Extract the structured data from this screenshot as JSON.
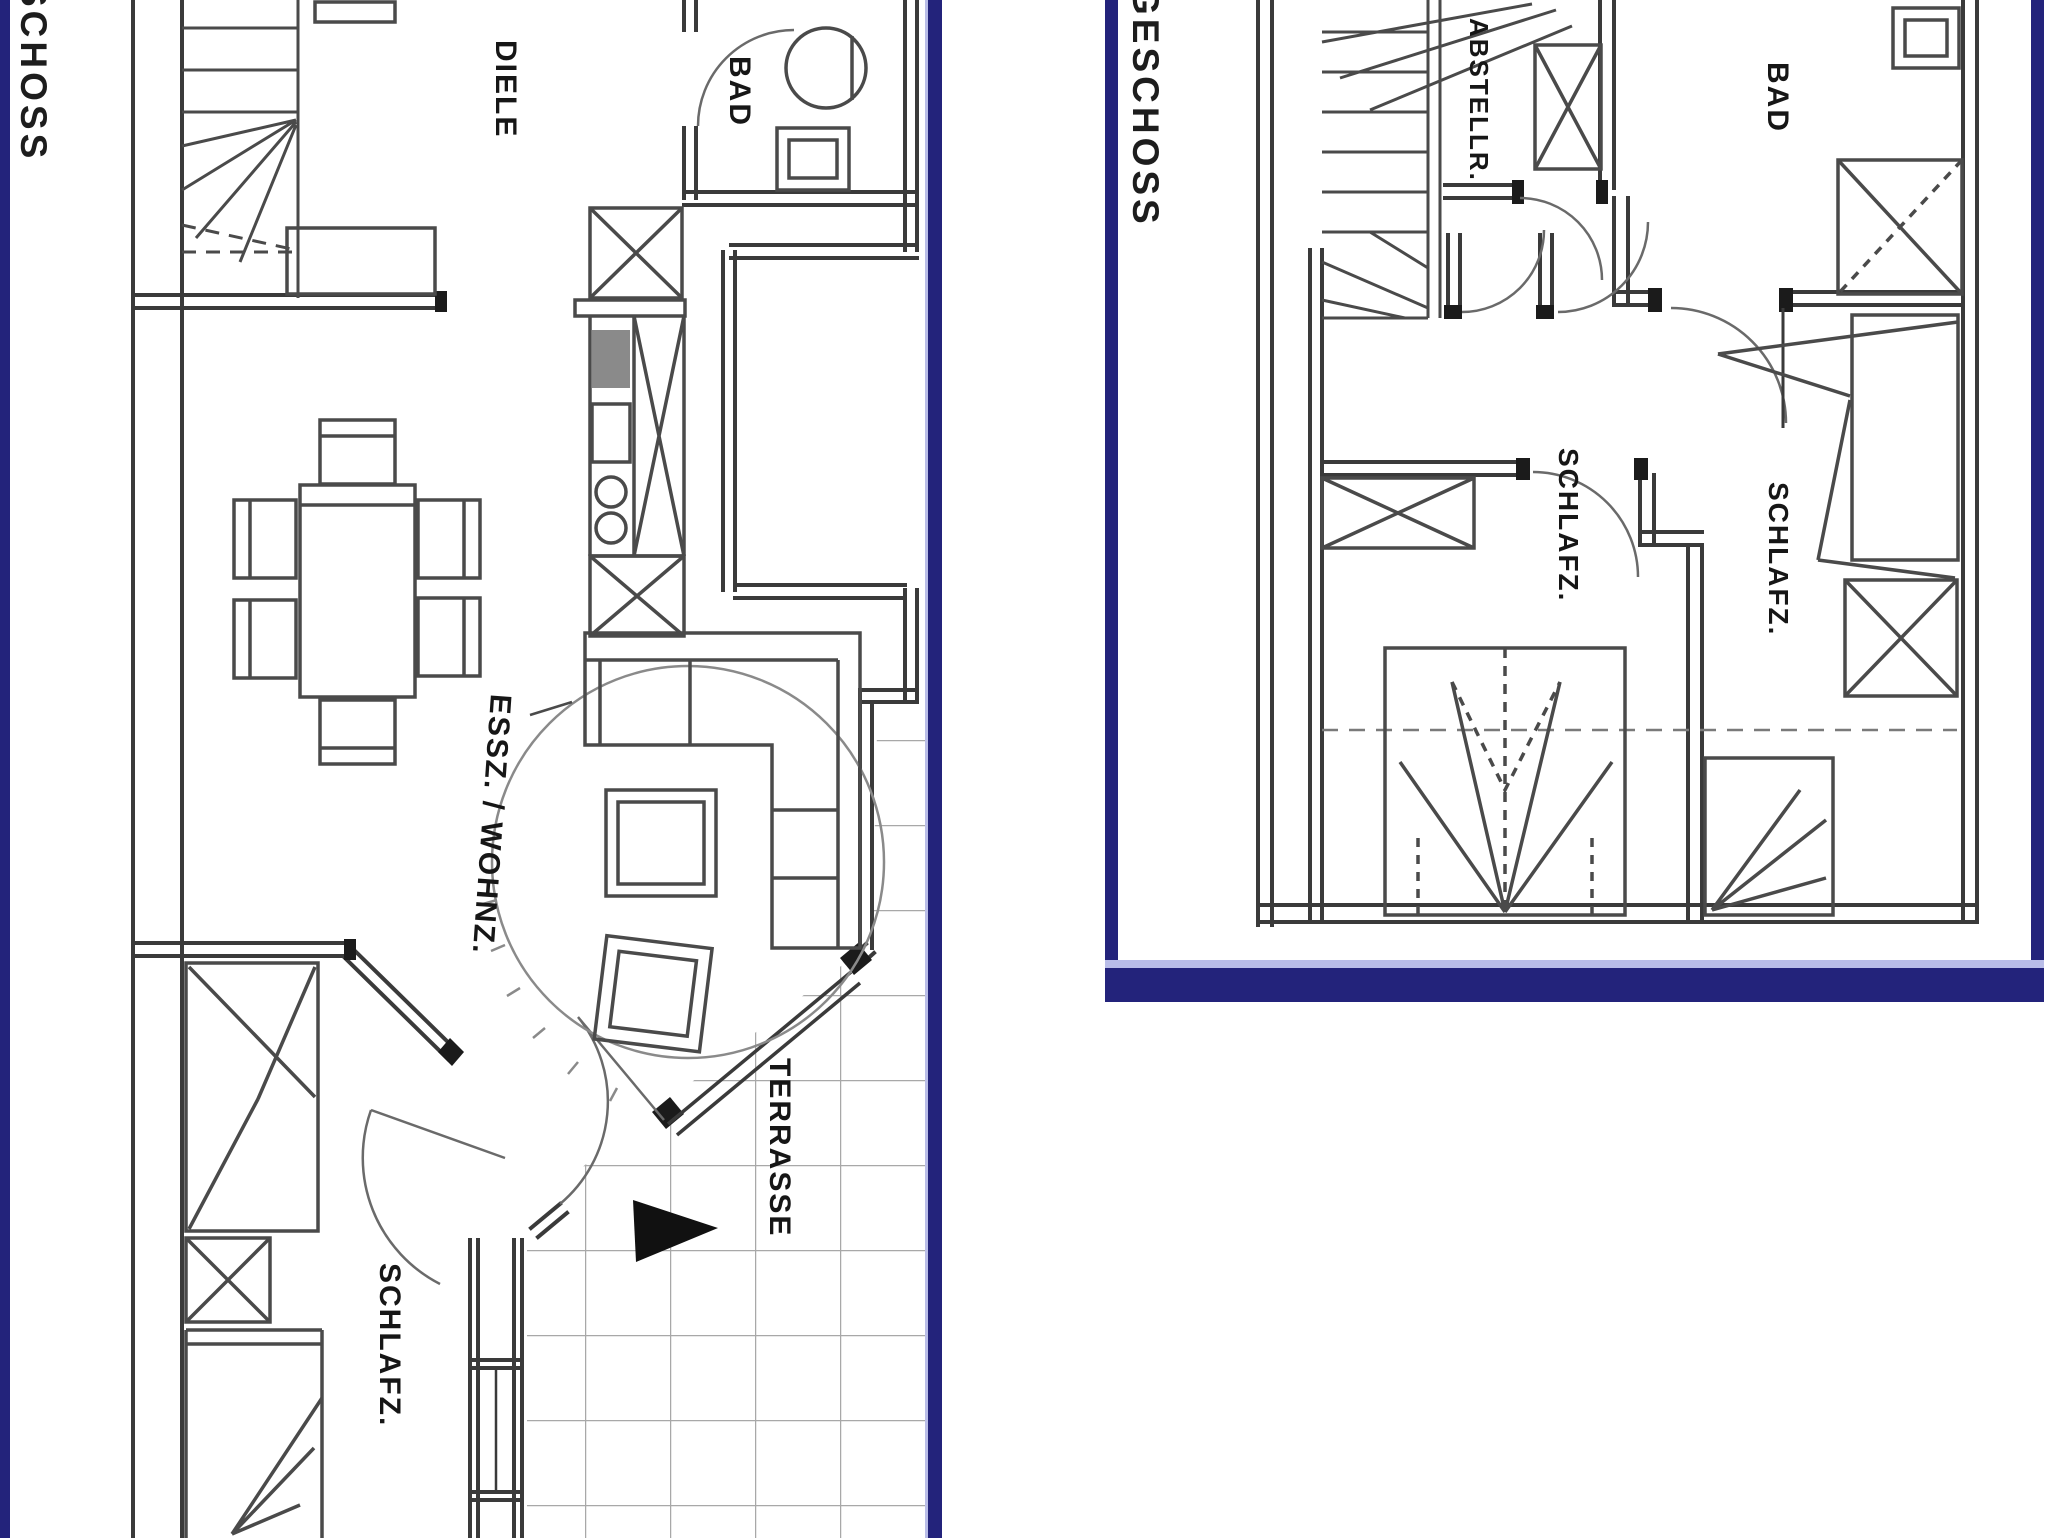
{
  "colors": {
    "frame_navy": "#23237b",
    "frame_light": "#b9bde8",
    "line_dark": "#3a3a3a",
    "line_heavy": "#1b1b1b",
    "tile_gray": "#a8a8a8"
  },
  "left_plan": {
    "floor_label": "SCHOSS",
    "rooms": {
      "diele": "DIELE",
      "bad": "BAD",
      "essz_wohnz": "ESSZ. / WOHNZ.",
      "schlafz": "SCHLAFZ.",
      "terrasse": "TERRASSE"
    }
  },
  "right_plan": {
    "floor_label": "GESCHOSS",
    "rooms": {
      "abstellraum": "ABSTELLR.",
      "bad": "BAD",
      "schlafz_1": "SCHLAFZ.",
      "schlafz_2": "SCHLAFZ."
    }
  }
}
